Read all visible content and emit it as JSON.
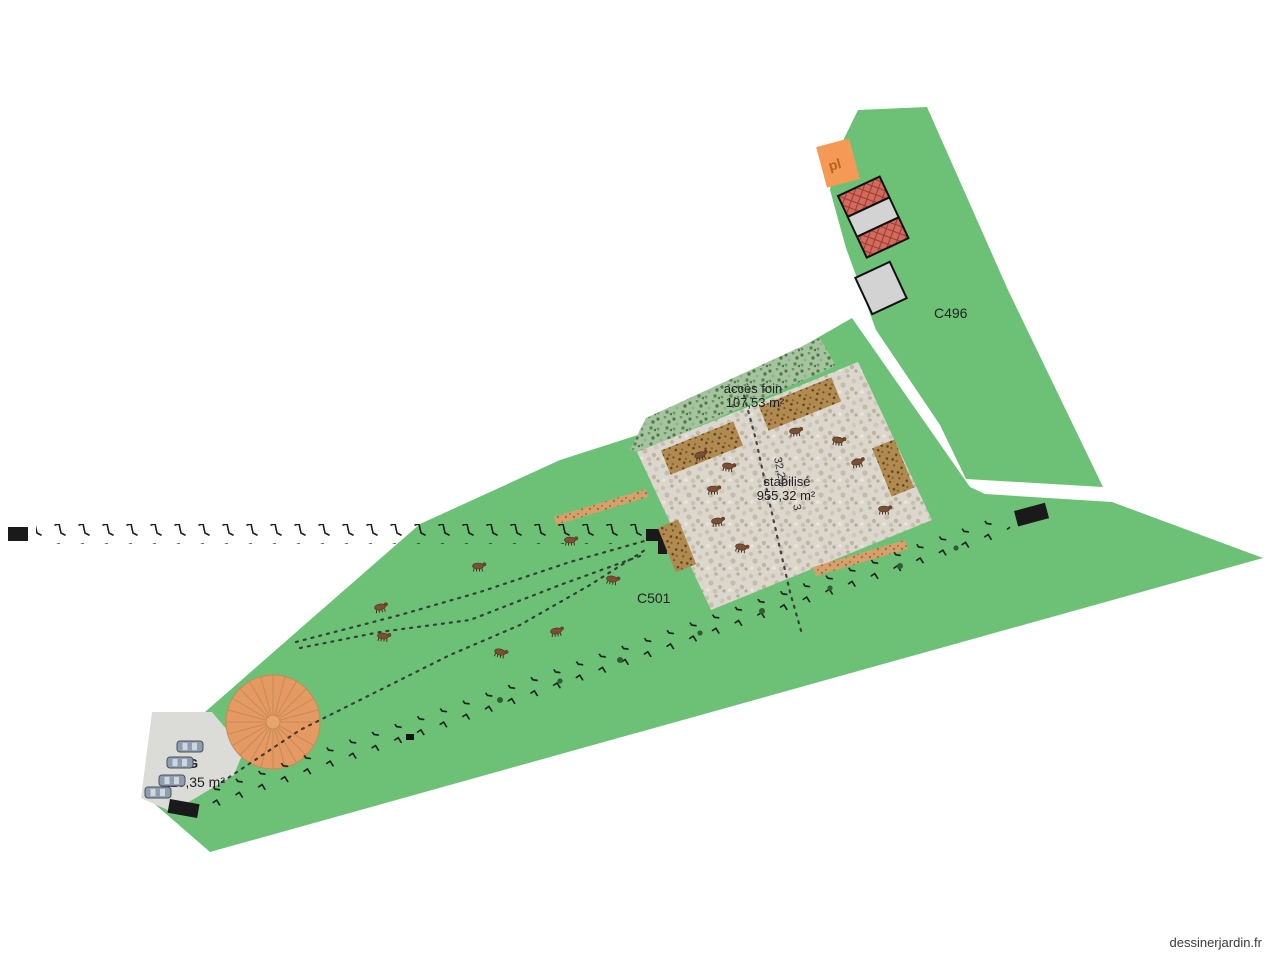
{
  "watermark": "dessinerjardin.fr",
  "parcels": {
    "c496_label": "C496",
    "c501_label": "C501"
  },
  "zones": {
    "acces_foin_label": "accès foin",
    "acces_foin_area": "107,53 m²",
    "stabilise_label": "stabilisé",
    "stabilise_area": "955,32 m²",
    "dimension_length": "32,29",
    "dimension_extra": "3",
    "parking_label": "PKG",
    "parking_area": "110,35 m²",
    "platform_label": "pl"
  },
  "icons": {
    "car": "car-top-view-icon",
    "cow": "cow-icon",
    "fence_post": "fence-post-icon",
    "gate": "gate-marker-icon",
    "round_building": "round-roof-building-icon",
    "hay": "hay-bale-icon"
  },
  "colors": {
    "parcel_green": "#6dc177",
    "gravel_base": "#dcd7cd",
    "hedge_green": "#a4c49e",
    "circle_orange": "#e49a62",
    "platform_orange": "#f49a56",
    "roof_red": "#d16b5e",
    "building_gray": "#d3d3d3",
    "parking_gray": "#dbdbd8",
    "hay_brown": "#b18a50",
    "path_tan": "#d6a06c"
  }
}
